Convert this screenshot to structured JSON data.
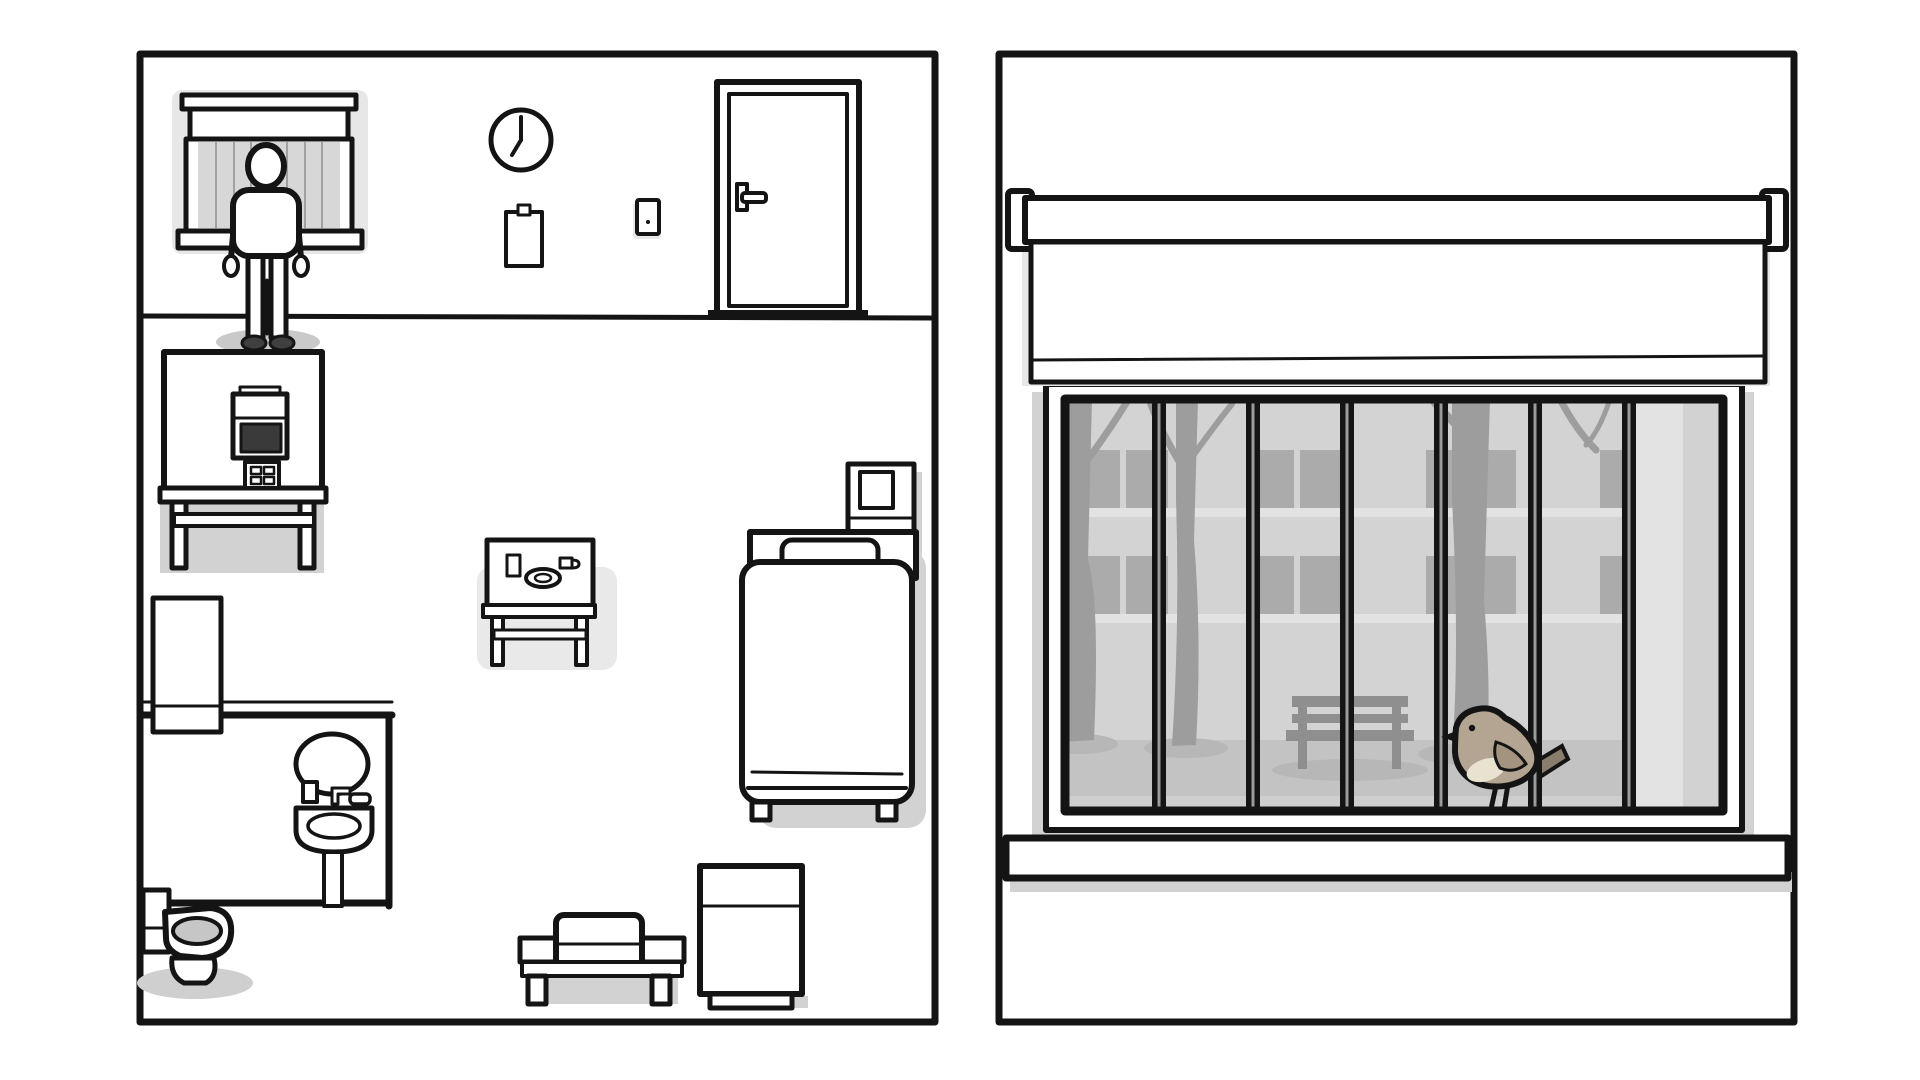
{
  "scene": {
    "left_panel": {
      "name": "room-overview",
      "objects": [
        "window-blinds",
        "man",
        "wall-clock",
        "clipboard",
        "light-switch",
        "door",
        "tv-on-desk",
        "fridge",
        "bathroom",
        "mirror",
        "sink",
        "toilet",
        "dining-table-with-meal",
        "bed",
        "nightstand",
        "sofa-bench",
        "cabinet"
      ],
      "clock_time": "7:00",
      "meal_items": [
        "glass",
        "plate",
        "cup"
      ]
    },
    "right_panel": {
      "name": "window-view",
      "objects": [
        "roller-blind",
        "barred-window",
        "bare-trees",
        "building-facade",
        "park-bench",
        "bird",
        "windowsill"
      ],
      "bird": "small tan bird perched on window frame facing left"
    }
  },
  "colors": {
    "ink": "#141414",
    "paper": "#ffffff",
    "blind_gray": "#d7d7d7",
    "glass": "#c9c9c9",
    "building": "#d3d3d3",
    "building_window": "#ababab",
    "ground": "#c3c3c3",
    "tree": "#9d9d9d",
    "bench": "#8f8f8f",
    "screen": "#3a3a3a",
    "shadow": "#d2d2d2",
    "bird_back": "#b4a593",
    "bird_belly": "#eae2d1",
    "bird_wing": "#a3937f",
    "bird_tail": "#8a7d6d"
  }
}
